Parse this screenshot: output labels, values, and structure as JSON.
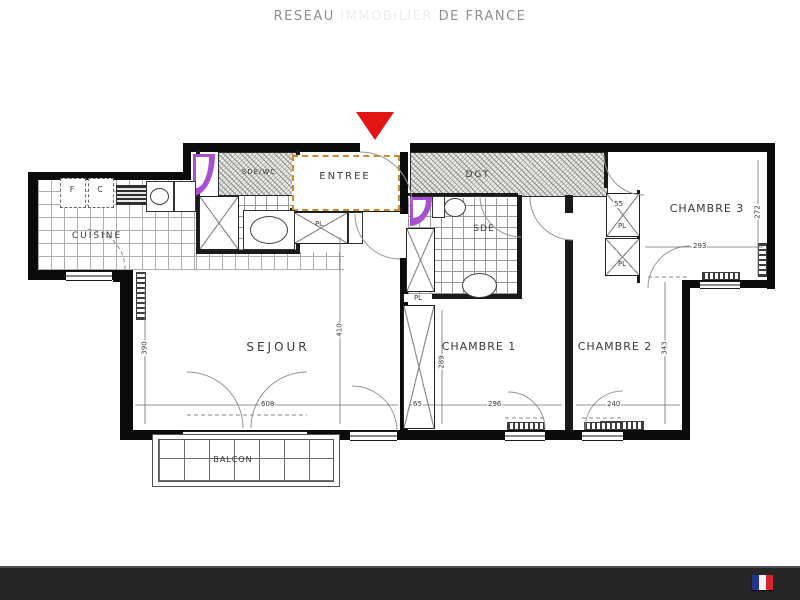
{
  "plan": {
    "rooms": {
      "cuisine": "CUISINE",
      "sejour": "SEJOUR",
      "entree": "ENTREE",
      "sde_wc": "SDE/WC",
      "dgt": "DGT",
      "sde": "SDE",
      "chambre1": "CHAMBRE 1",
      "chambre2": "CHAMBRE 2",
      "chambre3": "CHAMBRE 3",
      "balcon": "BALCON"
    },
    "closet_label": "PL",
    "kitchen_marks": {
      "f": "F",
      "c": "C"
    },
    "dims": {
      "sejour_w": "608",
      "sejour_h_left": "390",
      "sejour_h_right": "410",
      "pl_w": "65",
      "ch1_w": "296",
      "ch1_h": "289",
      "ch2_w": "240",
      "ch2_h": "343",
      "ch3_w": "293",
      "ch3_h": "272",
      "ch3_closet_w": "55"
    },
    "colors": {
      "wall": "#0b0b0b",
      "entrance_marker_red": "#e41414",
      "door_highlight_purple": "#a94fd1",
      "entree_dashed_orange": "#cf8a2e"
    }
  },
  "footer": {
    "brand_left": "RESEAU",
    "brand_mid": "IMMOBILIER",
    "brand_right": "DE FRANCE",
    "flag_colors": {
      "blue": "#27348b",
      "white": "#f2f2f2",
      "red": "#d6252c"
    }
  }
}
